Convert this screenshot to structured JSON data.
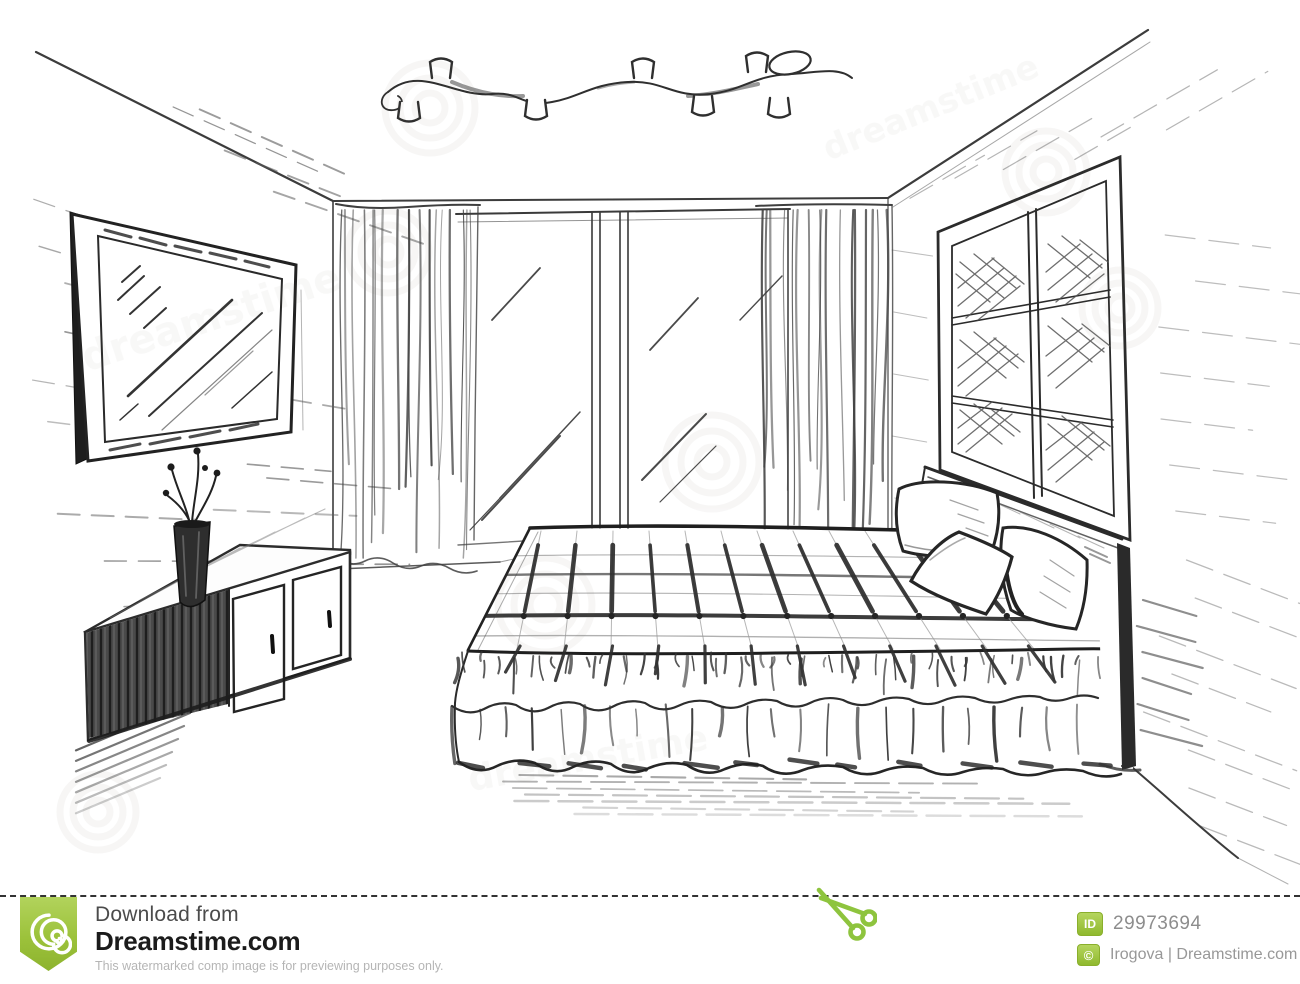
{
  "artwork": {
    "description": "Black-and-white pencil sketch of a bedroom interior: wall TV, low cabinet with vase, bed with plaid cover and double ruffle skirt, three pillows against a headboard, glass balcony doors with curtains, lattice window, ceiling spotlight track"
  },
  "watermark": {
    "text": "dreamstime",
    "symbol": "©"
  },
  "footer": {
    "download_from": "Download from",
    "brand": "Dreamstime.com",
    "disclaimer": "This watermarked comp image is for previewing purposes only.",
    "id_label": "ID",
    "image_id": "29973694",
    "copyright_symbol": "©",
    "credit": "Irogova | Dreamstime.com",
    "colors": {
      "brand_green": "#8ec43e",
      "badge_green": "#9cc23b",
      "text_dark": "#1b1b1b",
      "text_gray": "#4b4b4b",
      "text_light": "#b5b5b5",
      "id_text": "#8d8d8d",
      "cutline": "#333333",
      "sketch_stroke": "#2e2e2e"
    }
  }
}
